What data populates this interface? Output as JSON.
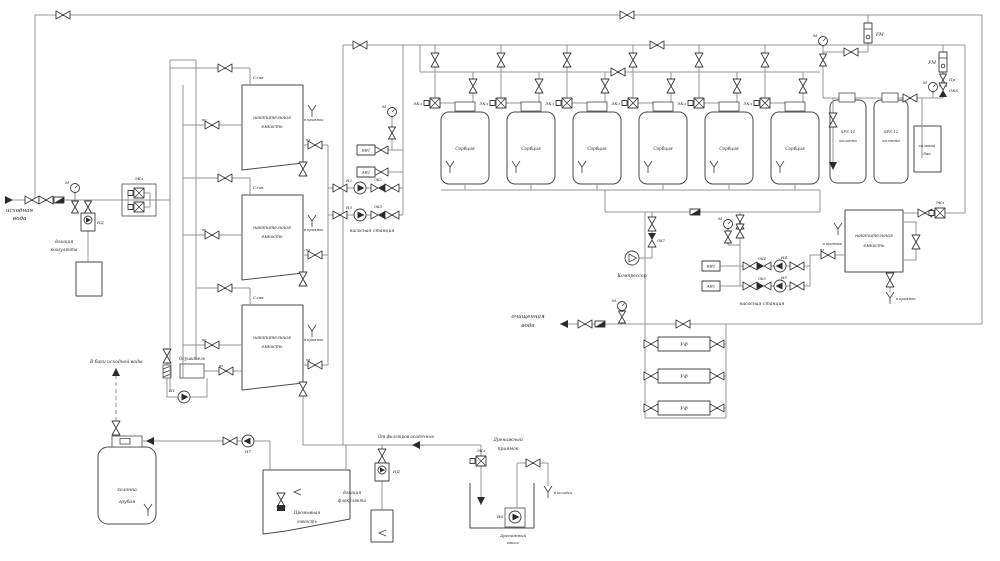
{
  "labels": {
    "src1": "исходная",
    "voda": "вода",
    "clean": "очищенная",
    "dos": "дозация",
    "coag": "коагулянта",
    "floc": "флокулянта",
    "stor1": "накопительная",
    "emk": "емкость",
    "sorb": "Сорбция",
    "sfs11": "SFS 11",
    "sfs12": "SFS 12",
    "col": "колонна",
    "coarse2": "грубая",
    "salt1": "солевой",
    "salt2": "бак",
    "ps": "насосная станция",
    "dryer": "Осушитель",
    "compr": "Компрессор",
    "uv": "УФ",
    "fm": "FM",
    "m": "М",
    "pr": "Пр",
    "ekl": "ЭКл",
    "sliv": "Слив",
    "sump": "в приямок",
    "well": "в колодец",
    "tosrc": "В баки исходной воды",
    "fromf": "От фильтров осадочных",
    "wash1": "Промывная",
    "dren": "Дренажный",
    "pria": "приямок",
    "nasos": "насос",
    "n1": "Н1",
    "n2": "Н2",
    "n3": "Н3",
    "n4": "Н4",
    "n5": "Н5",
    "n6": "Н6",
    "n7": "Н7",
    "nd": "НД",
    "ok2": "ОК2",
    "ok3": "ОК3",
    "ok4": "ОК4",
    "ok5": "ОК5",
    "ok6": "ОК6",
    "ok7": "ОК7",
    "kv1": "КВ1",
    "av1": "АВ1",
    "kv2": "КВ2",
    "av2": "АВ2",
    "no": "но",
    "nz": "нз"
  }
}
